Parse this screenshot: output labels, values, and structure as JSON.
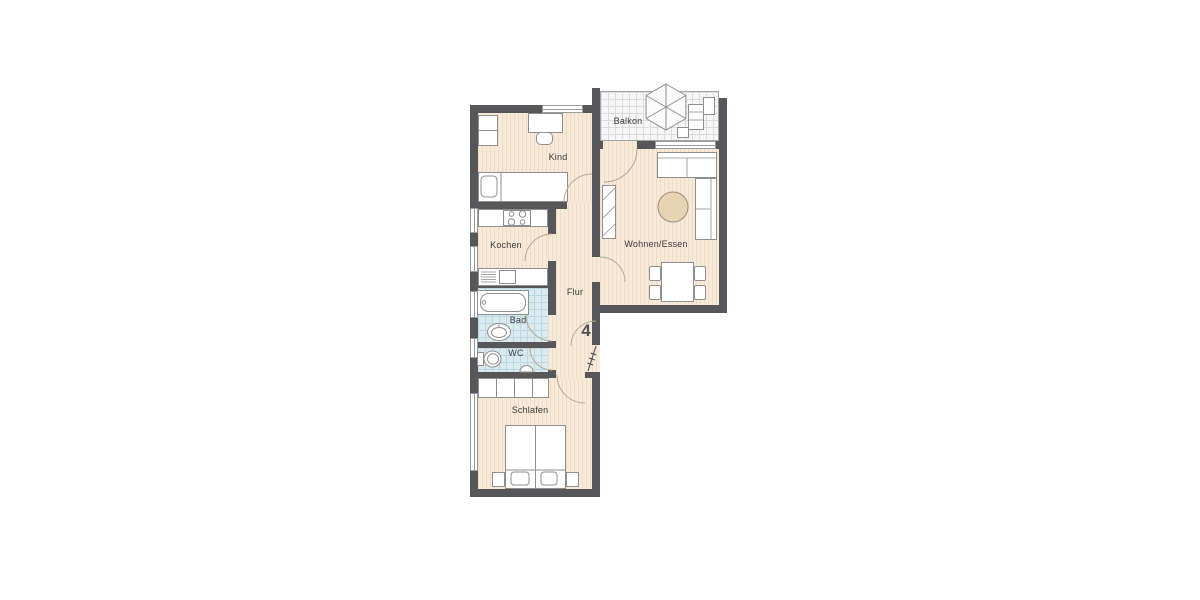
{
  "unit": {
    "number": "4"
  },
  "rooms": {
    "kind": {
      "label": "Kind",
      "furniture": [
        "single-bed",
        "desk",
        "desk-chair",
        "shelf"
      ]
    },
    "kochen": {
      "label": "Kochen",
      "furniture": [
        "stove-counter",
        "sink-counter"
      ]
    },
    "bad": {
      "label": "Bad",
      "furniture": [
        "bathtub",
        "washbasin"
      ]
    },
    "wc": {
      "label": "WC",
      "furniture": [
        "toilet",
        "small-washbasin"
      ]
    },
    "schlafen": {
      "label": "Schlafen",
      "furniture": [
        "double-bed",
        "wardrobe",
        "nightstand",
        "nightstand"
      ]
    },
    "flur": {
      "label": "Flur",
      "furniture": [
        "entrance-door"
      ]
    },
    "wohnen_essen": {
      "label": "Wohnen/Essen",
      "furniture": [
        "corner-sofa",
        "coffee-table",
        "dining-table",
        "dining-chairs",
        "shelf"
      ]
    },
    "balkon": {
      "label": "Balkon",
      "furniture": [
        "parasol",
        "lounger",
        "side-table"
      ]
    }
  },
  "colors": {
    "wall": "#57575a",
    "floor": "#f8ead9",
    "floor_stripe": "#efdcc8",
    "tile": "#d9eaf1",
    "tile_grid": "#bdd7e1",
    "balcony": "#f6f6f6",
    "balcony_grid": "#dcdcdc",
    "furniture_outline": "#8f8f8f",
    "accent_table": "#e7d2b2",
    "door_arc": "#b9a78f"
  }
}
